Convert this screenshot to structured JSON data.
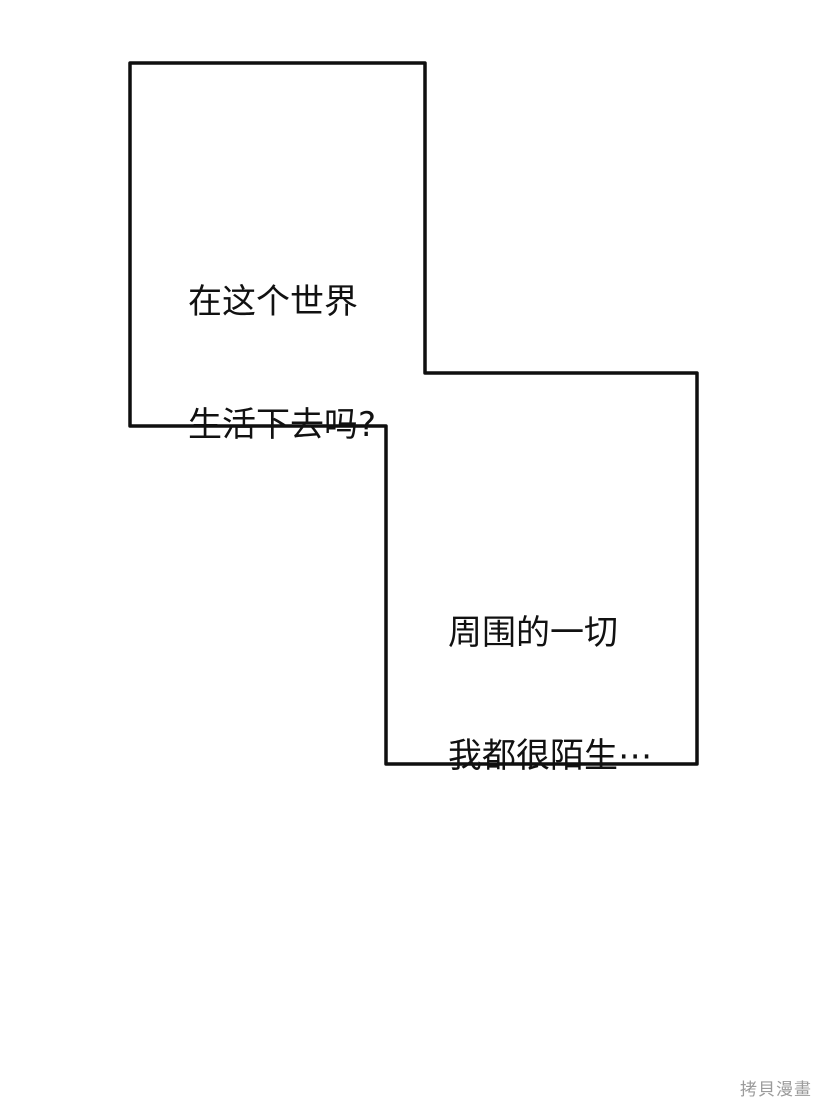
{
  "page": {
    "background": "#ffffff"
  },
  "colors": {
    "ink": "#0f0f0f",
    "panel_fill": "#ffffff",
    "text": "#111111",
    "watermark": "#9b9b9b"
  },
  "speech_bubbles": [
    {
      "id": "bubble-1",
      "lines": [
        "在这个世界",
        "生活下去吗?"
      ]
    },
    {
      "id": "bubble-2",
      "lines": [
        "周围的一切",
        "我都很陌生⋯"
      ]
    }
  ],
  "watermark": {
    "text": "拷貝漫畫"
  }
}
